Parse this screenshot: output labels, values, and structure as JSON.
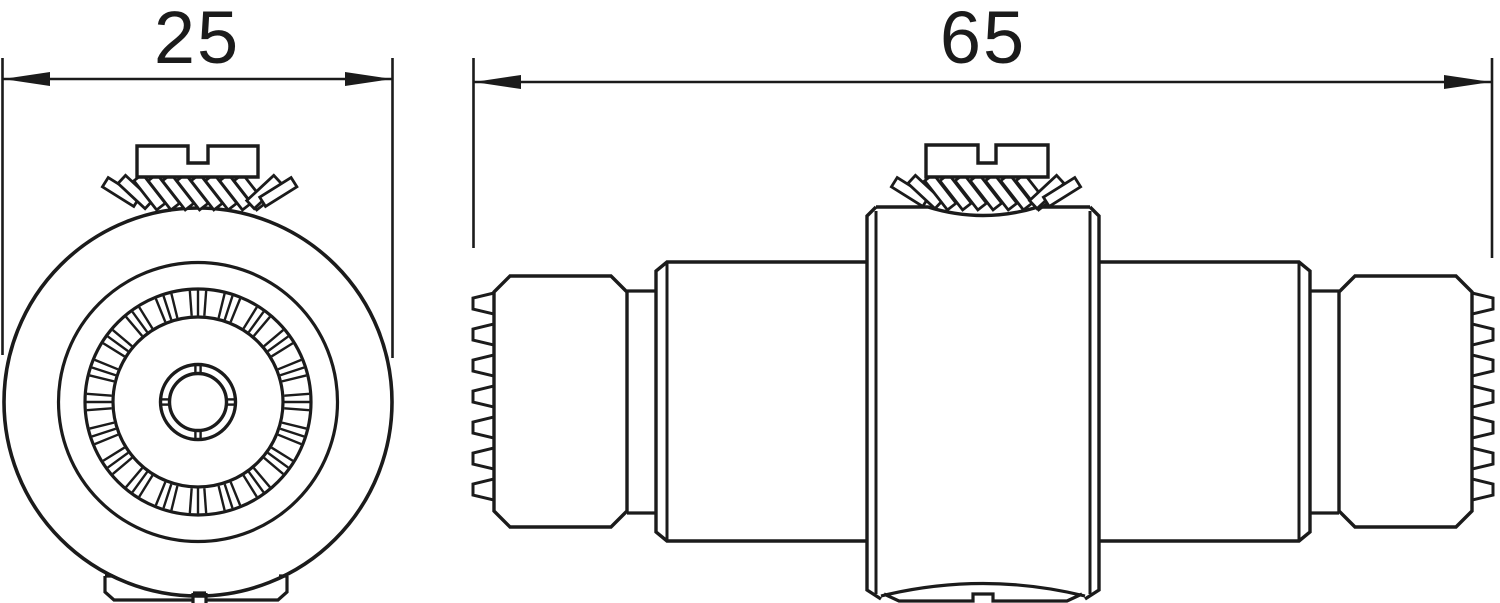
{
  "drawing": {
    "type": "technical-drawing",
    "views": {
      "front": "front-view-circular",
      "side": "side-view-elevation"
    },
    "dimensions": {
      "front_diameter": "25",
      "overall_length": "65"
    },
    "colors": {
      "background": "#ffffff",
      "line": "#1b1b1b"
    }
  }
}
